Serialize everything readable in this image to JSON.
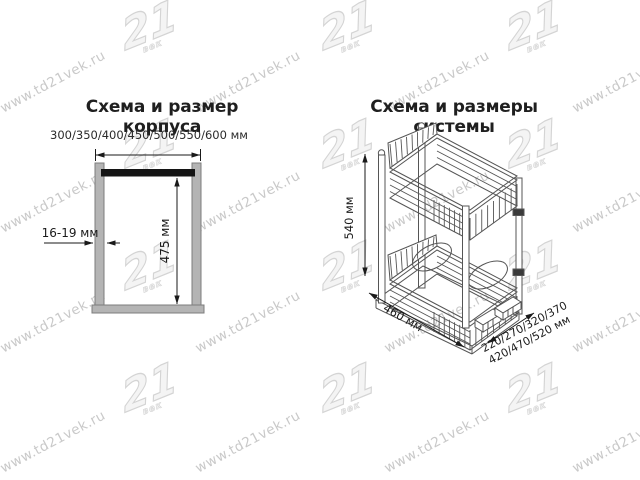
{
  "watermark": {
    "text": "www.td21vek.ru",
    "logo_text": "21",
    "logo_sub": "век",
    "color": "#c9c9c9"
  },
  "left_diagram": {
    "title": "Схема и размер корпуса",
    "width_options_label": "300/350/400/450/500/550/600 мм",
    "panel_thickness_label": "16-19 мм",
    "inner_height_label": "475 мм"
  },
  "right_diagram": {
    "title": "Схема и размеры системы",
    "height_label": "540 мм",
    "length_label": "460 мм",
    "width_options_line1": "220/270/320/370",
    "width_options_line2": "420/470/520 мм"
  },
  "colors": {
    "panel_fill": "#b4b4b4",
    "panel_border": "#7d7d7d",
    "dimension_line": "#1a1a1a",
    "drawing_line": "#555555",
    "top_rail": "#141414"
  }
}
